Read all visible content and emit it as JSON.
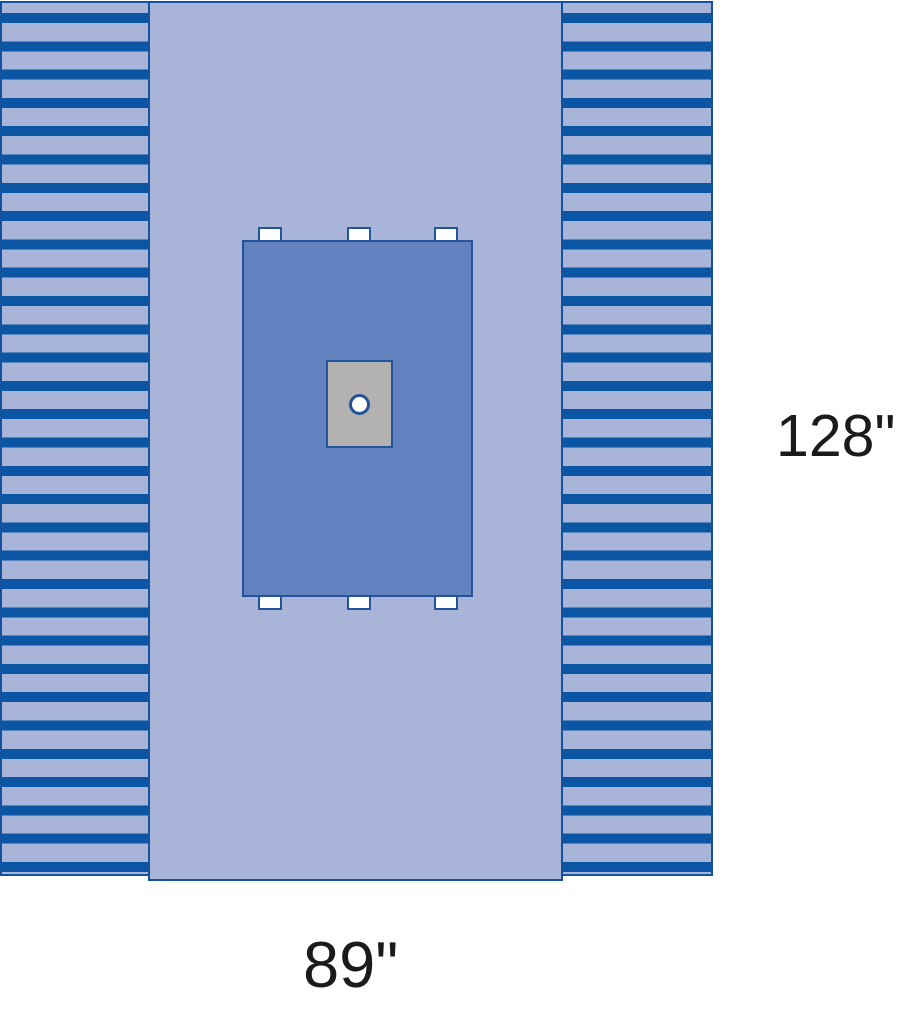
{
  "canvas": {
    "width_px": 900,
    "height_px": 1019
  },
  "dimensions": {
    "height_label": "128\"",
    "width_label": "89\""
  },
  "colors": {
    "bg": "#ffffff",
    "drape-light": "#a8b4d8",
    "stripe-blue": "#0a56a4",
    "panel-border": "#15529e",
    "reinf-fill": "#6182be",
    "reinf-border": "#24529b",
    "patch-gray": "#b3b2b0",
    "tab-fill": "#ffffff",
    "label-text": "#1b1b1b"
  }
}
